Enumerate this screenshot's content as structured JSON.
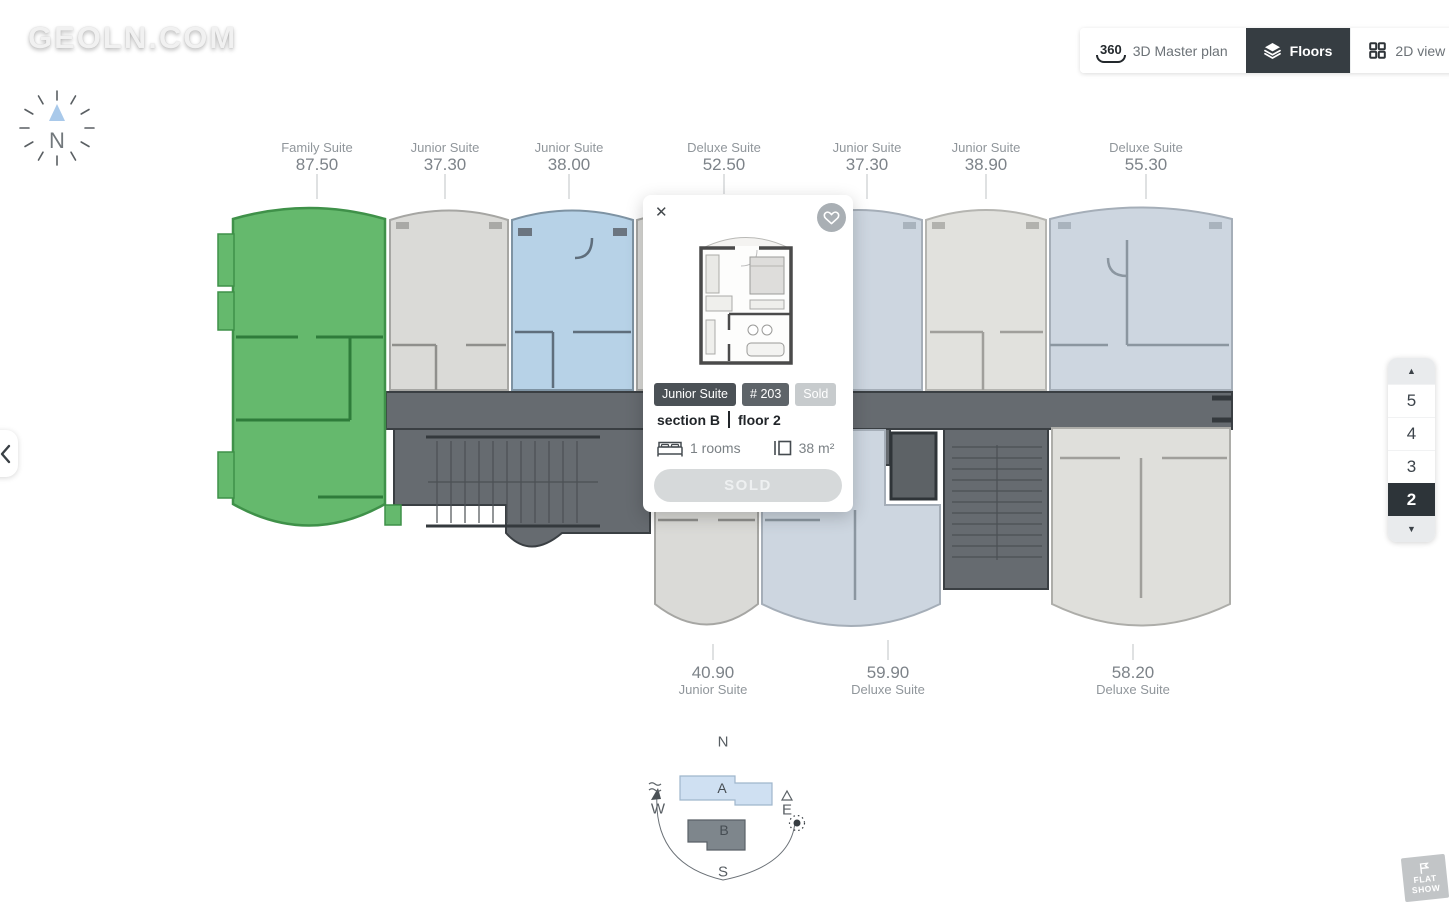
{
  "logo": "GEOLN.COM",
  "toolbar": {
    "badge_360": "360",
    "master_plan": "3D Master plan",
    "floors": "Floors",
    "view_2d": "2D view"
  },
  "compass": {
    "north": "N"
  },
  "units_top": [
    {
      "name": "Family Suite",
      "area": "87.50"
    },
    {
      "name": "Junior Suite",
      "area": "37.30"
    },
    {
      "name": "Junior Suite",
      "area": "38.00"
    },
    {
      "name": "Deluxe Suite",
      "area": "52.50"
    },
    {
      "name": "Junior Suite",
      "area": "37.30"
    },
    {
      "name": "Junior Suite",
      "area": "38.90"
    },
    {
      "name": "Deluxe Suite",
      "area": "55.30"
    }
  ],
  "units_bottom": [
    {
      "area": "40.90",
      "name": "Junior Suite"
    },
    {
      "area": "59.90",
      "name": "Deluxe Suite"
    },
    {
      "area": "58.20",
      "name": "Deluxe Suite"
    }
  ],
  "popup": {
    "close": "✕",
    "type": "Junior Suite",
    "number": "# 203",
    "status": "Sold",
    "section": "section B",
    "floor": "floor 2",
    "rooms": "1 rooms",
    "area": "38 m²",
    "action": "SOLD"
  },
  "floor_panel": {
    "up": "▲",
    "down": "▼",
    "floors": [
      "5",
      "4",
      "3",
      "2"
    ],
    "selected": "2"
  },
  "minimap": {
    "north": "N",
    "west": "W",
    "east": "E",
    "south": "S",
    "section_a": "A",
    "section_b": "B"
  },
  "watermark": {
    "line1": "FLAT",
    "line2": "SHOW"
  },
  "colors": {
    "available_green": "#65b96d",
    "selected_blue": "#b7d2e7",
    "unit_gray": "#dadad7",
    "unit_pale_blue": "#cdd6e0",
    "corridor_dark": "#666b70",
    "active_dark": "#363d42"
  }
}
